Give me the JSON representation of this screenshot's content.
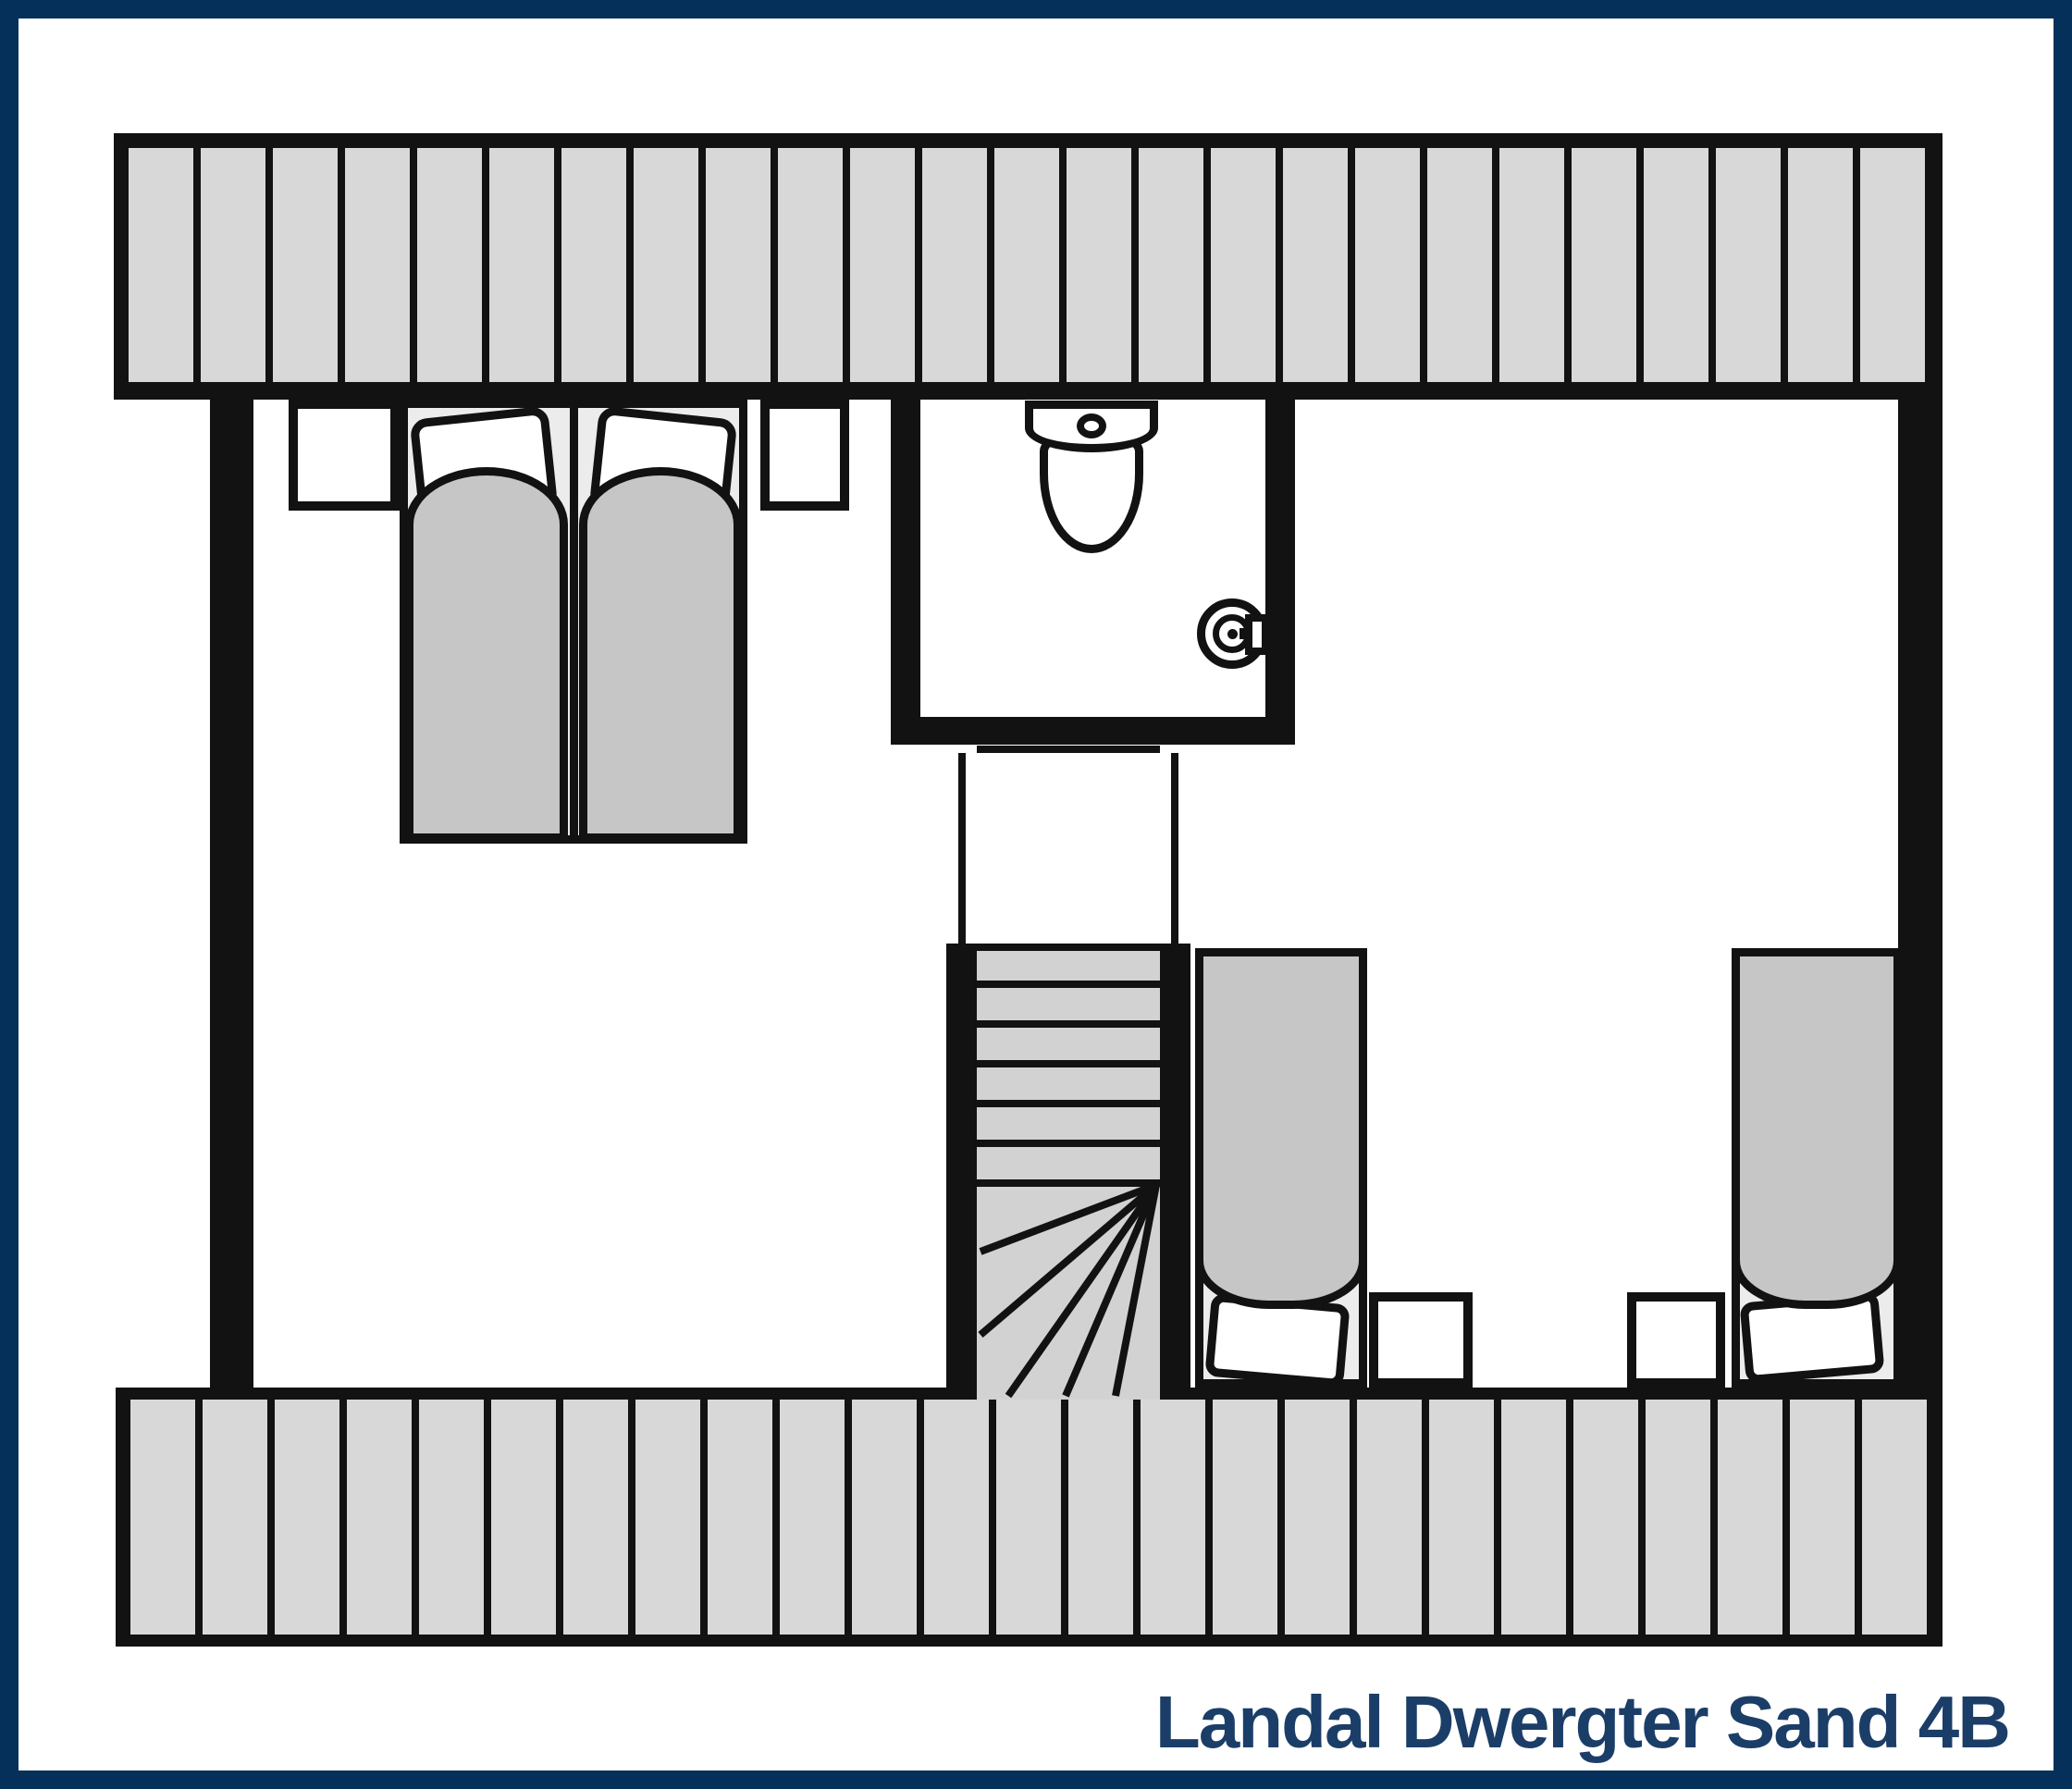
{
  "title": "Landal Dwergter Sand 4B",
  "colors": {
    "navy": "#05305a",
    "title_text": "#1b3e68",
    "ink": "#121212",
    "stripe_fill": "#d8d8d8",
    "duvet_fill": "#c6c6c6",
    "bed_base_fill": "#ececec",
    "step_fill": "#d2d2d2",
    "floor": "#ffffff"
  },
  "plan": {
    "type": "floor-plan",
    "floor": "upper floor (attic) with hatched roof bands top and bottom",
    "rooms": [
      {
        "name": "bedroom-left",
        "furniture": [
          "double-bed (two mattresses, two tilted pillows, two duvets)",
          "nightstand-left",
          "nightstand-right"
        ]
      },
      {
        "name": "bathroom",
        "furniture": [
          "toilet (tank with flush knob and bowl)",
          "round-washbasin with faucet on right wall"
        ]
      },
      {
        "name": "staircase",
        "furniture": [
          "landing with double-line railings",
          "six straight treads",
          "winder treads fanning from top-right pivot"
        ]
      },
      {
        "name": "bedroom-right",
        "furniture": [
          "single-bed-left (pillow at foot wall)",
          "nightstand-a",
          "nightstand-b",
          "single-bed-right (pillow at foot wall)"
        ]
      }
    ]
  }
}
